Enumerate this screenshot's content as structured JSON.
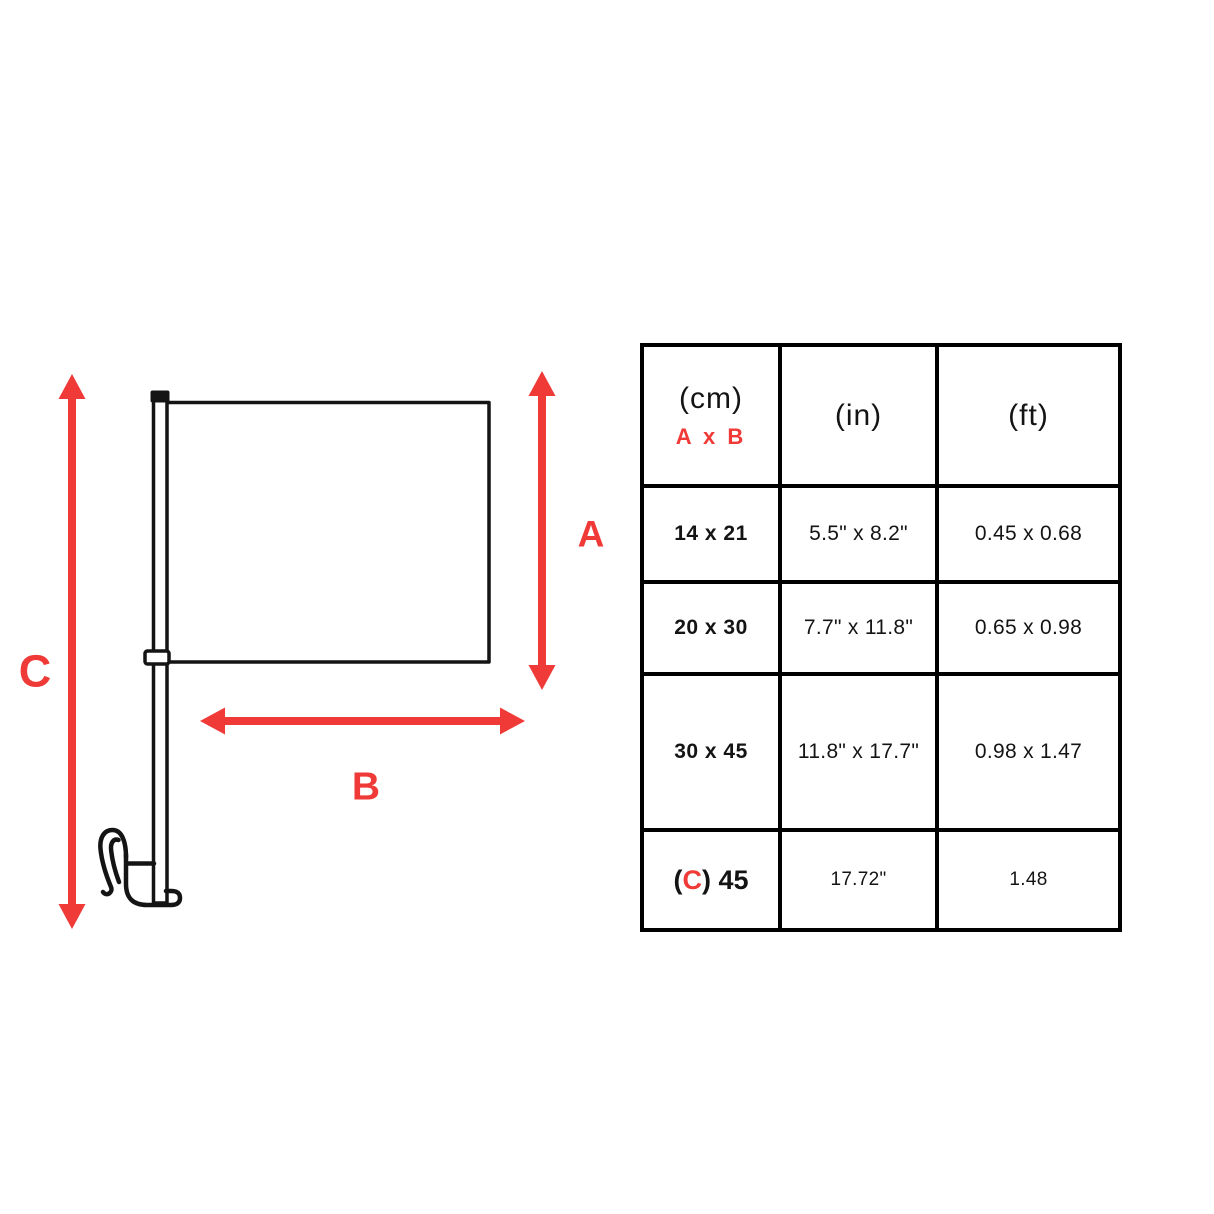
{
  "colors": {
    "accent_red": "#ef3a37",
    "ink": "#141414",
    "table_border": "#000000",
    "background": "#ffffff"
  },
  "diagram": {
    "labels": {
      "a": "A",
      "b": "B",
      "c": "C"
    }
  },
  "size_table": {
    "header": {
      "cm": "(cm)",
      "axb": "A x B",
      "inches": "(in)",
      "feet": "(ft)"
    },
    "rows": [
      {
        "cm": "14 x 21",
        "in": "5.5\" x 8.2\"",
        "ft": "0.45 x 0.68"
      },
      {
        "cm": "20 x 30",
        "in": "7.7\" x 11.8\"",
        "ft": "0.65 x 0.98"
      },
      {
        "cm": "30 x 45",
        "in": "11.8\" x 17.7\"",
        "ft": "0.98 x 1.47"
      }
    ],
    "row_c": {
      "label_prefix": "(",
      "label_highlight": "C",
      "label_suffix": ") 45",
      "in": "17.72\"",
      "ft": "1.48"
    }
  }
}
